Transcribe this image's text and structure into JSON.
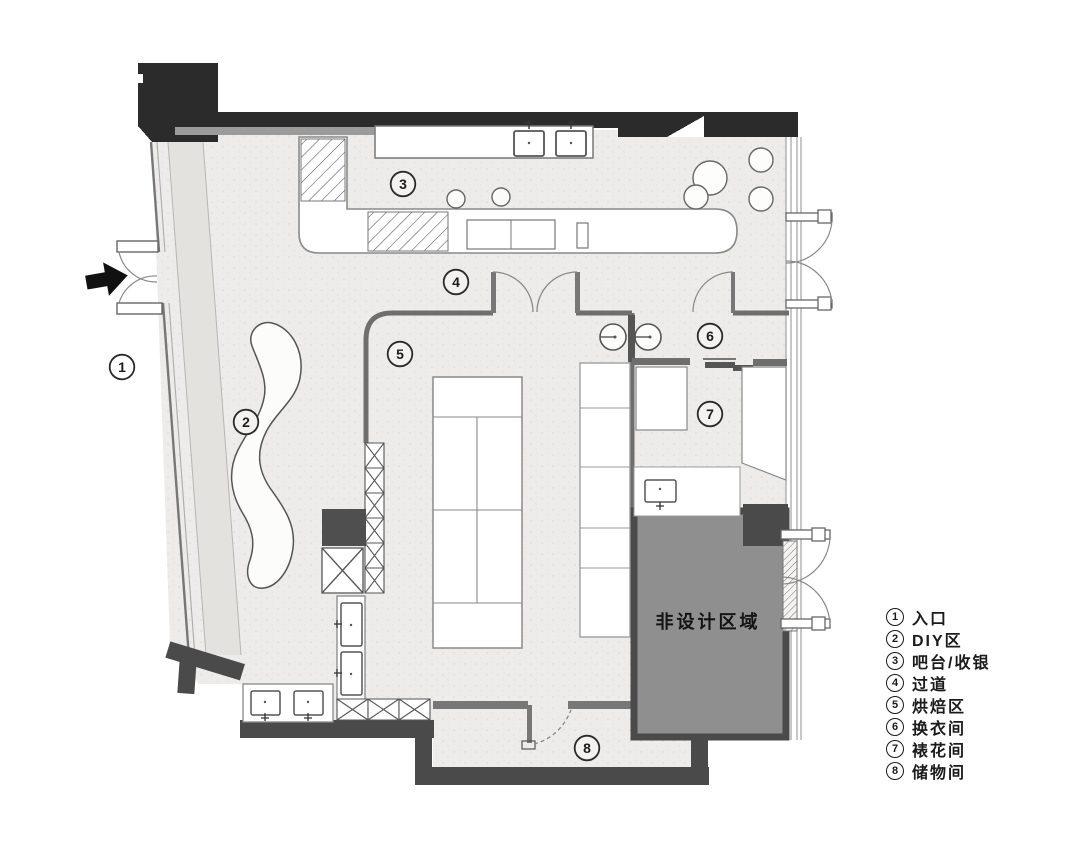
{
  "plan": {
    "non_design_label": "非设计区域",
    "labels": [
      "1",
      "2",
      "3",
      "4",
      "5",
      "6",
      "7",
      "8"
    ],
    "icons": {
      "entrance_arrow": "black-right-arrow"
    },
    "colors": {
      "wall_dark": "#2b2b2b",
      "wall_gray": "#4a4a4a",
      "wall_line": "#6e6e6e",
      "non_design_fill": "#8f8f8f",
      "floor": "#edecea"
    }
  },
  "legend": {
    "items": [
      {
        "num": "1",
        "label": "入口"
      },
      {
        "num": "2",
        "label": "DIY区"
      },
      {
        "num": "3",
        "label": "吧台/收银"
      },
      {
        "num": "4",
        "label": "过道"
      },
      {
        "num": "5",
        "label": "烘焙区"
      },
      {
        "num": "6",
        "label": "换衣间"
      },
      {
        "num": "7",
        "label": "裱花间"
      },
      {
        "num": "8",
        "label": "储物间"
      }
    ]
  }
}
